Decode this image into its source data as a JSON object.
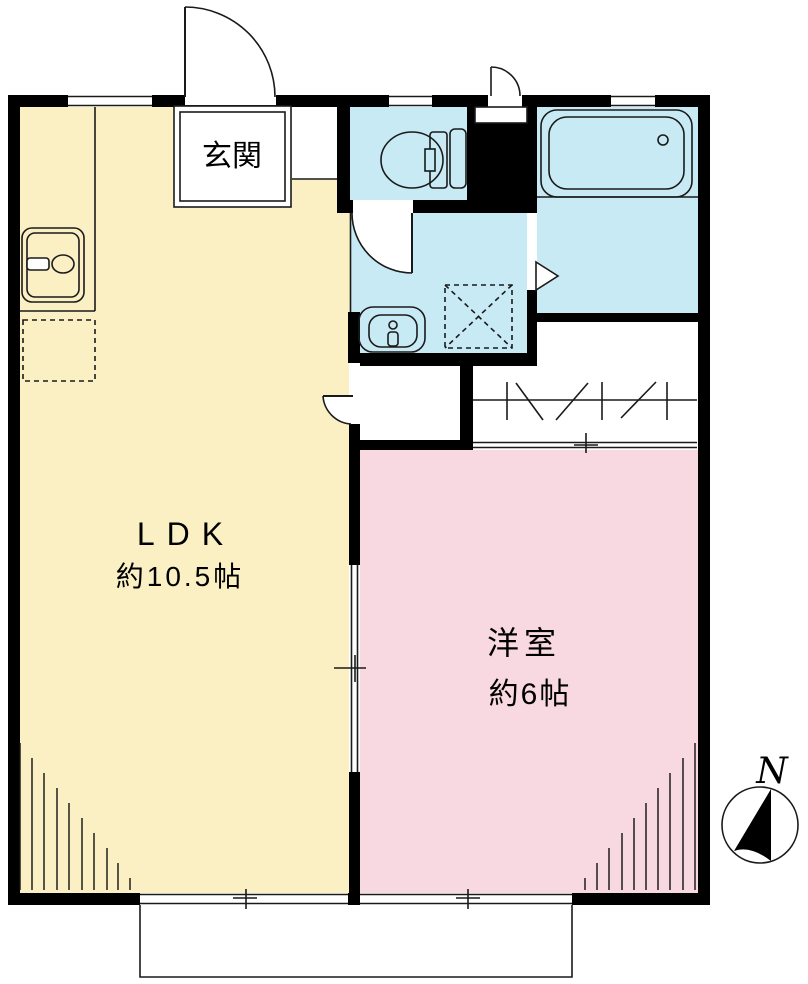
{
  "floorplan": {
    "genkan_label": "玄関",
    "ldk_label": "LDK",
    "ldk_area": "約10.5帖",
    "western_room_label": "洋室",
    "western_room_area": "約6帖",
    "compass_label": "N"
  },
  "colors": {
    "ldk_fill": "#FAF0C4",
    "western_room_fill": "#F9D9E1",
    "wet_area_fill": "#C8EAF5",
    "wall": "#000000",
    "line": "#1A1A1A",
    "background": "#FFFFFF"
  }
}
